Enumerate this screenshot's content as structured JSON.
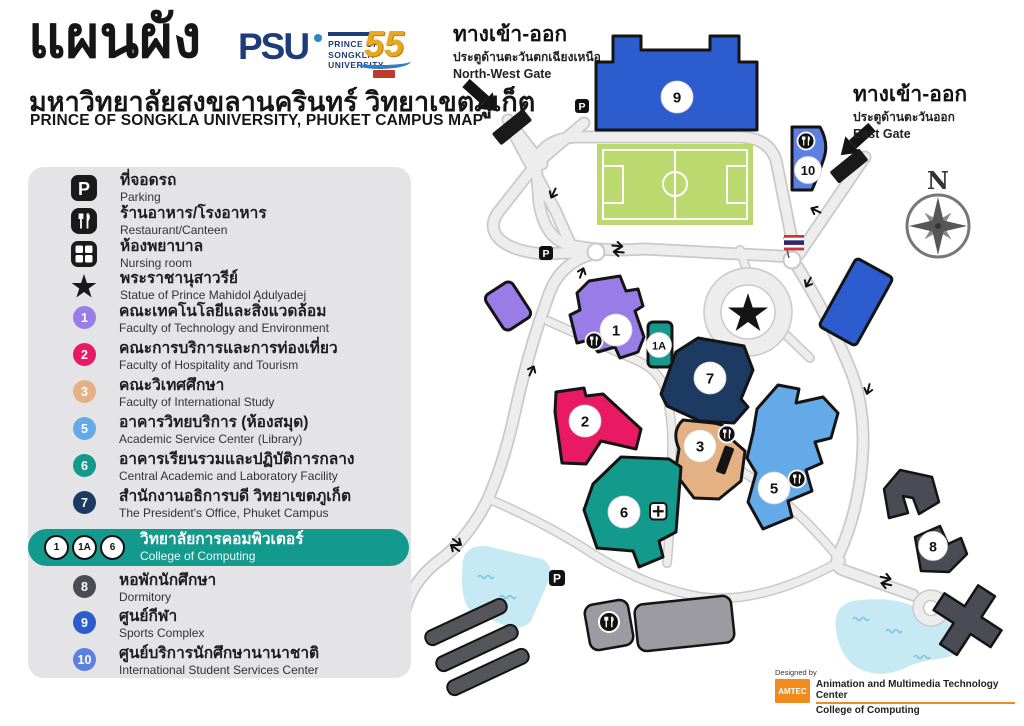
{
  "header": {
    "title_thai": "แผนผัง",
    "subtitle_thai": "มหาวิทยาลัยสงขลานครินทร์ วิทยาเขตภูเก็ต",
    "subtitle_en": "PRINCE OF SONGKLA UNIVERSITY, PHUKET CAMPUS MAP",
    "logo": {
      "psu": "PSU",
      "psu_lines": [
        "PRINCE OF",
        "SONGKLA",
        "UNIVERSITY"
      ],
      "anniversary": "55"
    }
  },
  "colors": {
    "purple": "#9a7ce6",
    "pink": "#e91a63",
    "tan": "#e3b183",
    "light_blue": "#64a9e8",
    "teal": "#14998d",
    "navy": "#1d3a63",
    "dark_gray": "#4b4b55",
    "blue": "#2d5ccf",
    "blue_light": "#5d7fe2",
    "building_gray": "#9b9ba1",
    "field_green": "#bcd96f",
    "pond_blue": "#c7e9f3",
    "panel_gray": "#e4e4e6",
    "amtec_orange": "#f08c1e",
    "highlight_teal": "#14998d"
  },
  "legend": {
    "items": [
      {
        "icon": "parking-icon",
        "thai": "ที่จอดรถ",
        "en": "Parking"
      },
      {
        "icon": "restaurant-icon",
        "thai": "ร้านอาหาร/โรงอาหาร",
        "en": "Restaurant/Canteen"
      },
      {
        "icon": "nursing-icon",
        "thai": "ห้องพยาบาล",
        "en": "Nursing room"
      },
      {
        "icon": "star-icon",
        "thai": "พระราชานุสาวรีย์",
        "en": "Statue of Prince Mahidol Adulyadej"
      },
      {
        "marker": "1",
        "color": "#9a7ce6",
        "thai": "คณะเทคโนโลยีและสิ่งแวดล้อม",
        "en": "Faculty of Technology and Environment"
      },
      {
        "marker": "2",
        "color": "#e91a63",
        "thai": "คณะการบริการและการท่องเที่ยว",
        "en": "Faculty of Hospitality and Tourism"
      },
      {
        "marker": "3",
        "color": "#e3b183",
        "thai": "คณะวิเทศศึกษา",
        "en": "Faculty of International Study"
      },
      {
        "marker": "5",
        "color": "#64a9e8",
        "thai": "อาคารวิทยบริการ (ห้องสมุด)",
        "en": "Academic Service Center (Library)"
      },
      {
        "marker": "6",
        "color": "#14998d",
        "thai": "อาคารเรียนรวมและปฏิบัติการกลาง",
        "en": "Central Academic and Laboratory Facility"
      },
      {
        "marker": "7",
        "color": "#1d3a63",
        "thai": "สำนักงานอธิการบดี วิทยาเขตภูเก็ต",
        "en": "The President's Office, Phuket Campus"
      },
      {
        "marker": "8",
        "color": "#4b4b55",
        "thai": "หอพักนักศึกษา",
        "en": "Dormitory"
      },
      {
        "marker": "9",
        "color": "#2d5ccf",
        "thai": "ศูนย์กีฬา",
        "en": "Sports Complex"
      },
      {
        "marker": "10",
        "color": "#5d7fe2",
        "thai": "ศูนย์บริการนักศึกษานานาชาติ",
        "en": "International Student Services Center"
      }
    ],
    "highlight": {
      "markers": [
        "1",
        "1A",
        "6"
      ],
      "color": "#14998d",
      "thai": "วิทยาลัยการคอมพิวเตอร์",
      "en": "College of Computing"
    }
  },
  "map": {
    "gates": {
      "northwest": {
        "thai": "ทางเข้า-ออก",
        "sub_thai": "ประตูด้านตะวันตกเฉียงเหนือ",
        "en": "North-West Gate"
      },
      "east": {
        "thai": "ทางเข้า-ออก",
        "sub_thai": "ประตูด้านตะวันออก",
        "en": "East Gate"
      }
    },
    "compass_n": "N",
    "parking_letter": "P",
    "markers": [
      {
        "label": "9"
      },
      {
        "label": "10"
      },
      {
        "label": "1"
      },
      {
        "label": "1A"
      },
      {
        "label": "7"
      },
      {
        "label": "2"
      },
      {
        "label": "3"
      },
      {
        "label": "5"
      },
      {
        "label": "6"
      },
      {
        "label": "8"
      }
    ]
  },
  "credits": {
    "designed_by": "Designed by",
    "org": "AMTEC",
    "line1": "Animation and Multimedia Technology Center",
    "line2": "College of Computing"
  }
}
